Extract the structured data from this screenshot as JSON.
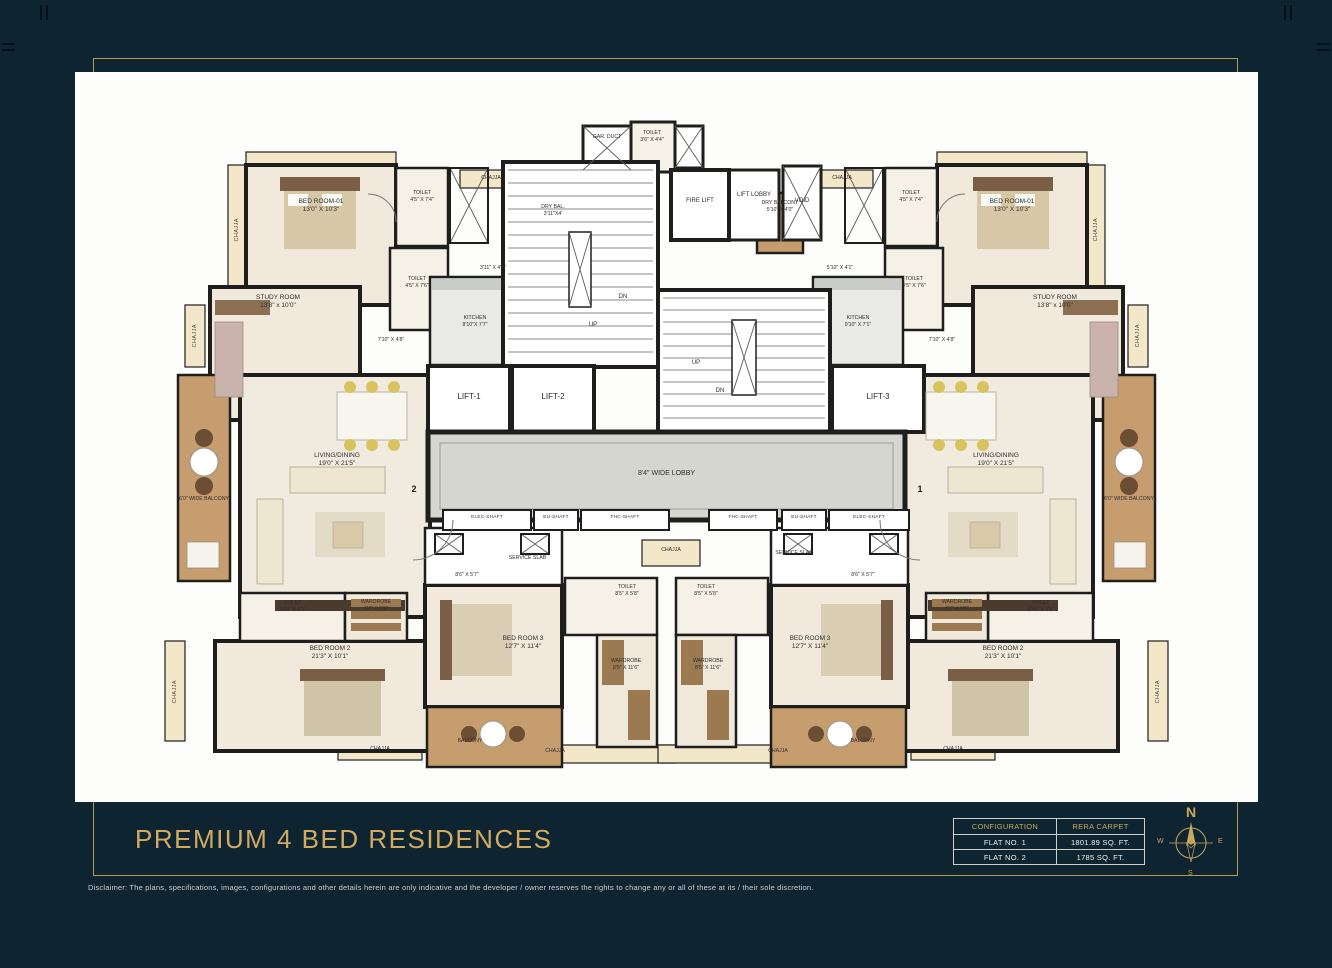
{
  "page": {
    "title": "PREMIUM 4 BED RESIDENCES",
    "disclaimer": "Disclaimer: The plans, specifications, images, configurations and other details herein are only indicative and the developer / owner reserves the rights to change any or all of these at its / their sole discretion."
  },
  "area_table": {
    "headers": [
      "CONFIGURATION",
      "RERA CARPET"
    ],
    "rows": [
      [
        "FLAT NO. 1",
        "1801.89 SQ. FT."
      ],
      [
        "FLAT NO. 2",
        "1785 SQ. FT."
      ]
    ]
  },
  "compass": {
    "north": "N",
    "south": "S",
    "east": "E",
    "west": "W"
  },
  "common": {
    "chajja": "CHAJJA",
    "balcony": "BALCONY",
    "service_slab": "SERVICE SLAB",
    "toilet": "TOILET",
    "wardrobe": "WARDROBE",
    "kitchen": "KITCHEN",
    "study_room": "STUDY ROOM",
    "living_dining": "LIVING/DINING",
    "bedroom1": "BED ROOM-01",
    "bedroom2": "BED ROOM 2",
    "bedroom3": "BED ROOM 3",
    "wide_balcony": "6'0\" WIDE BALCONY"
  },
  "core": {
    "gar_duct": "GAR. DUCT",
    "toilet_dims": "3'6\" X 4'4\"",
    "fire_lift": "FIRE LIFT",
    "lift_lobby": "LIFT LOBBY",
    "void": "VOID",
    "up": "UP",
    "dn": "DN",
    "lift1": "LIFT-1",
    "lift2": "LIFT-2",
    "lift3": "LIFT-3",
    "lobby": "8'4\" WIDE LOBBY",
    "elec_shaft": "ELEC-SHAFT",
    "eu_shaft": "EU-SHAFT",
    "fhc_shaft": "FHC-SHAFT"
  },
  "flat2": {
    "number": "2",
    "bedroom1_dims": "13'0\" X 10'3\"",
    "toilet_a_dims": "4'5\" X 7'4\"",
    "toilet_b_dims": "4'5\" X 7'6\"",
    "dry_bal": "DRY BAL.",
    "dry_bal_dims": "3'11\"X4'",
    "dry_bal_outer_dims": "3'11\" X 4'1\"",
    "kitchen_dims": "8'10\"X 7'7\"",
    "passage_dims": "7'10\" X 4'8\"",
    "study_dims": "13'8\" x 10'0\"",
    "living_dims": "19'0\" X 21'5\"",
    "toilet2_dims": "10'6\" X 4'1\"",
    "wardrobe2_dims": "6'7\" X 5'8\"",
    "bedroom2_dims": "21'3\" X 10'1\"",
    "service_dims": "8'6\" X 5'7\"",
    "bedroom3_dims": "12'7\" X 11'4\"",
    "toilet3_dims": "8'5\" X 5'8\"",
    "wardrobe3_dims": "8'5\" X 11'6\""
  },
  "flat1": {
    "number": "1",
    "bedroom1_dims": "13'0\" X 10'3\"",
    "toilet_a_dims": "4'5\" X 7'4\"",
    "toilet_b_dims": "4'5\" X 7'6\"",
    "dry_bal": "DRY BALCONY",
    "dry_bal_dims": "5'10\" X 4'0\"",
    "dry_bal_outer_dims": "5'10\" X 4'1\"",
    "kitchen_dims": "9'10\" X 7'1\"",
    "passage_dims": "7'10\" X 4'8\"",
    "study_dims": "13'8\" x 10'0\"",
    "living_dims": "19'0\" X 21'5\"",
    "toilet2_dims": "10'6\" X 4'1\"",
    "wardrobe2_dims": "6'7\" X 5'8\"",
    "bedroom2_dims": "21'3\" X 10'1\"",
    "service_dims": "8'6\" X 5'7\"",
    "bedroom3_dims": "12'7\" X 11'4\"",
    "toilet3_dims": "8'5\" X 5'8\"",
    "wardrobe3_dims": "8'5\" X 11'6\""
  }
}
